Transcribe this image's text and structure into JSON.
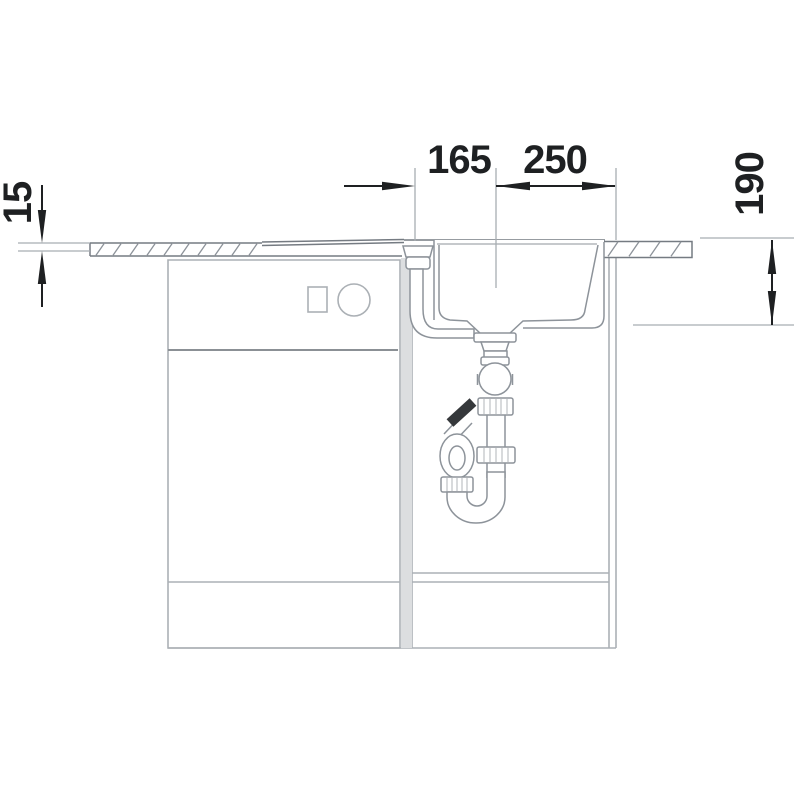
{
  "drawing": {
    "dimension_labels": {
      "top_left": "165",
      "top_right": "250",
      "left_side": "15",
      "right_side": "190"
    },
    "colors": {
      "background": "#ffffff",
      "dimension": "#1e2022",
      "extension_line": "#a8adb2",
      "drawing_line": "#8d939a",
      "countertop_line": "#757b82",
      "cabinet_line": "#abb0b5",
      "cabinet_divider": "#8b9095",
      "gap_fill": "#dcdee0",
      "spigot": "#35383b"
    }
  }
}
